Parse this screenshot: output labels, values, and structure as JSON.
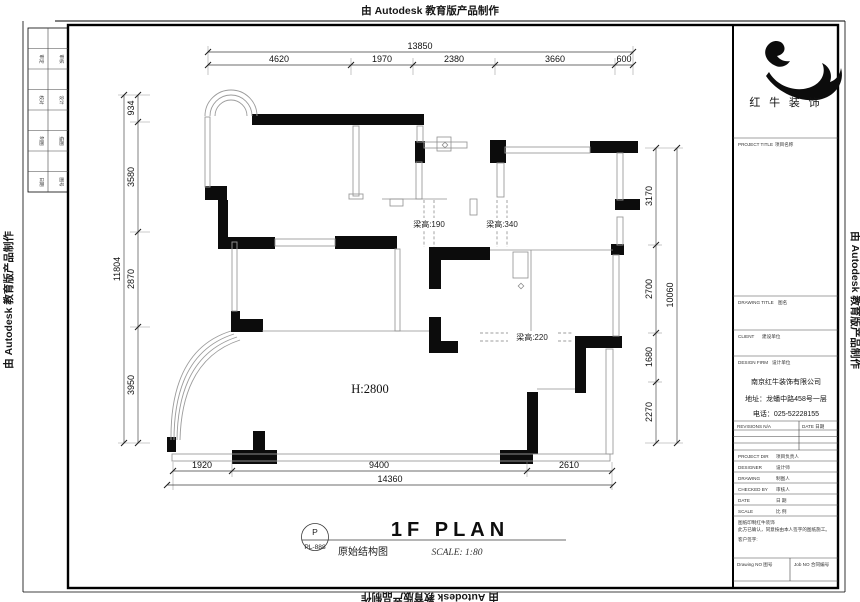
{
  "edge_text": "由 Autodesk 教育版产品制作",
  "dims": {
    "top": {
      "overall": "13850",
      "segments": [
        "4620",
        "1970",
        "2380",
        "3660",
        "600"
      ]
    },
    "left": {
      "overall": "11804",
      "segments": [
        "934",
        "3580",
        "2870",
        "3950"
      ]
    },
    "right": {
      "overall": "10060",
      "segments": [
        "3170",
        "2700",
        "1680",
        "2270"
      ]
    },
    "bottom": {
      "overall": "14360",
      "segments": [
        "1920",
        "9400",
        "2610"
      ]
    }
  },
  "plan_labels": {
    "beam_190": "梁高:190",
    "beam_340": "梁高:340",
    "beam_220": "梁高:220",
    "ceiling_height": "H:2800"
  },
  "title_group": {
    "circle_top": "P",
    "circle_no": "PL-888",
    "title": "1F PLAN",
    "subtitle": "原始结构图",
    "scale": "SCALE: 1:80"
  },
  "title_block": {
    "brand": "红 牛 装 饰",
    "project_title": "PROJECT TITLE",
    "project_title_cn": "项目名称",
    "drawing_title": "DRAWING TITLE",
    "drawing_title_cn": "图名",
    "client": "CLIENT",
    "client_cn": "建设单位",
    "design_firm": "DESIGN FIRM",
    "design_firm_cn": "设计单位",
    "company_name": "南京红牛装饰有限公司",
    "company_address": "地址：龙蟠中路458号一层",
    "company_phone": "电话：025-52228155",
    "revisions": "REVISIONS N/A",
    "date_header": "DATE 日期",
    "project_dir": "PROJECT DIR",
    "project_dir_cn": "项目负责人",
    "designer": "DESIGNER",
    "designer_cn": "设计师",
    "drawing": "DRAWING",
    "drawing_cn": "制图人",
    "checked": "CHECKED BY",
    "checked_cn": "审核人",
    "date": "DATE",
    "date_cn": "日 期",
    "scale": "SCALE",
    "scale_cn": "比 例",
    "note1": "图纸印制红牛装饰",
    "note2": "此方已确认，同意按由本人签字的图纸施工。",
    "note3": "客户签字:",
    "drawing_no": "Drawing NO 图号",
    "job_no": "Job NO 合同编号"
  },
  "left_strip": {
    "rows": [
      [
        "审定",
        "审核"
      ],
      [
        "校对",
        "设计"
      ],
      [
        "制图",
        "描图"
      ],
      [
        "日期",
        "图号"
      ]
    ]
  },
  "colors": {
    "wall": "#0c0c0c",
    "thin_line": "#9b9b9b",
    "dim_line": "#3d3d3d"
  }
}
